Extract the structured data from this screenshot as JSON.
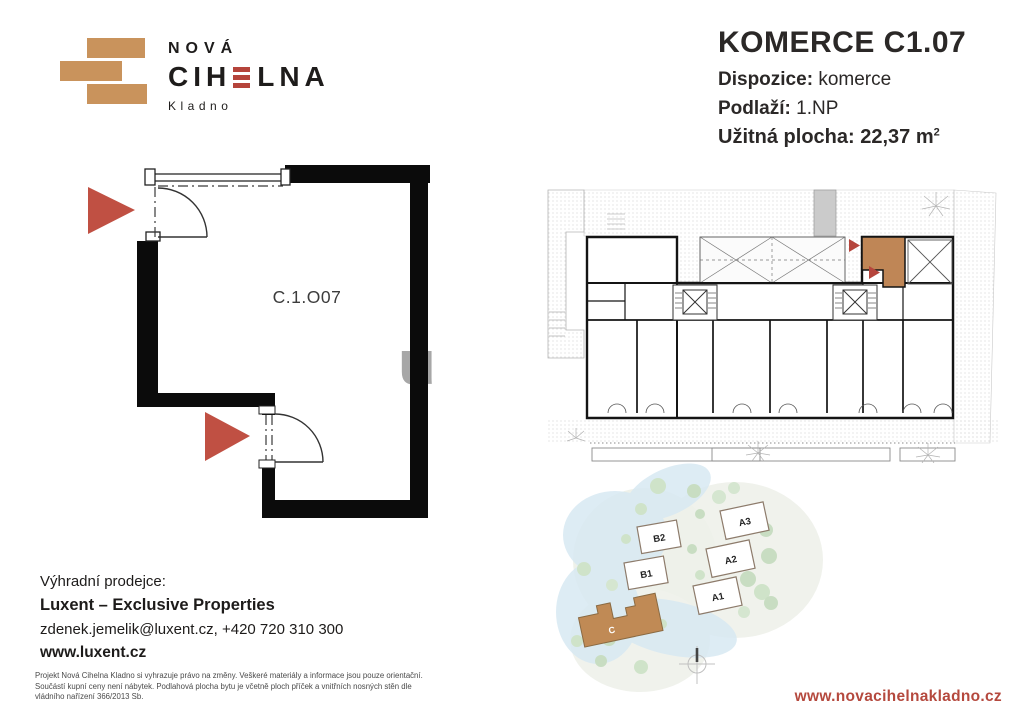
{
  "logo": {
    "nova": "NOVÁ",
    "cihelna_left": "CIH",
    "cihelna_right": "LNA",
    "city": "Kladno"
  },
  "header": {
    "title": "KOMERCE C1.07",
    "dispozice_label": "Dispozice:",
    "dispozice_value": "komerce",
    "podlazi_label": "Podlaží:",
    "podlazi_value": "1.NP",
    "plocha_label": "Užitná plocha:",
    "plocha_value": "22,37 m",
    "plocha_sup": "2"
  },
  "floor_plan": {
    "unit_label": "C.1.O07",
    "watermark": "u"
  },
  "site_plan": {
    "b2": "B2",
    "b1": "B1",
    "a3": "A3",
    "a2": "A2",
    "a1": "A1",
    "c": "C"
  },
  "footer": {
    "seller_label": "Výhradní prodejce:",
    "seller_name": "Luxent – Exclusive Properties",
    "seller_contact": "zdenek.jemelik@luxent.cz, +420 720 310 300",
    "seller_web": "www.luxent.cz",
    "disclaimer": "Projekt Nová Cihelna Kladno si vyhrazuje právo na změny. Veškeré materiály a informace jsou pouze orientační. Součástí kupní ceny není nábytek. Podlahová plocha bytu je včetně ploch příček a vnitřních nosných stěn dle vládního nařízení 366/2013 Sb.",
    "website": "www.novacihelnakladno.cz"
  },
  "colors": {
    "brand_tan": "#c9935c",
    "brand_red": "#b5443b",
    "arrow_red": "#c05043",
    "highlight_unit": "#bf8656",
    "link_red": "#b5493e"
  }
}
